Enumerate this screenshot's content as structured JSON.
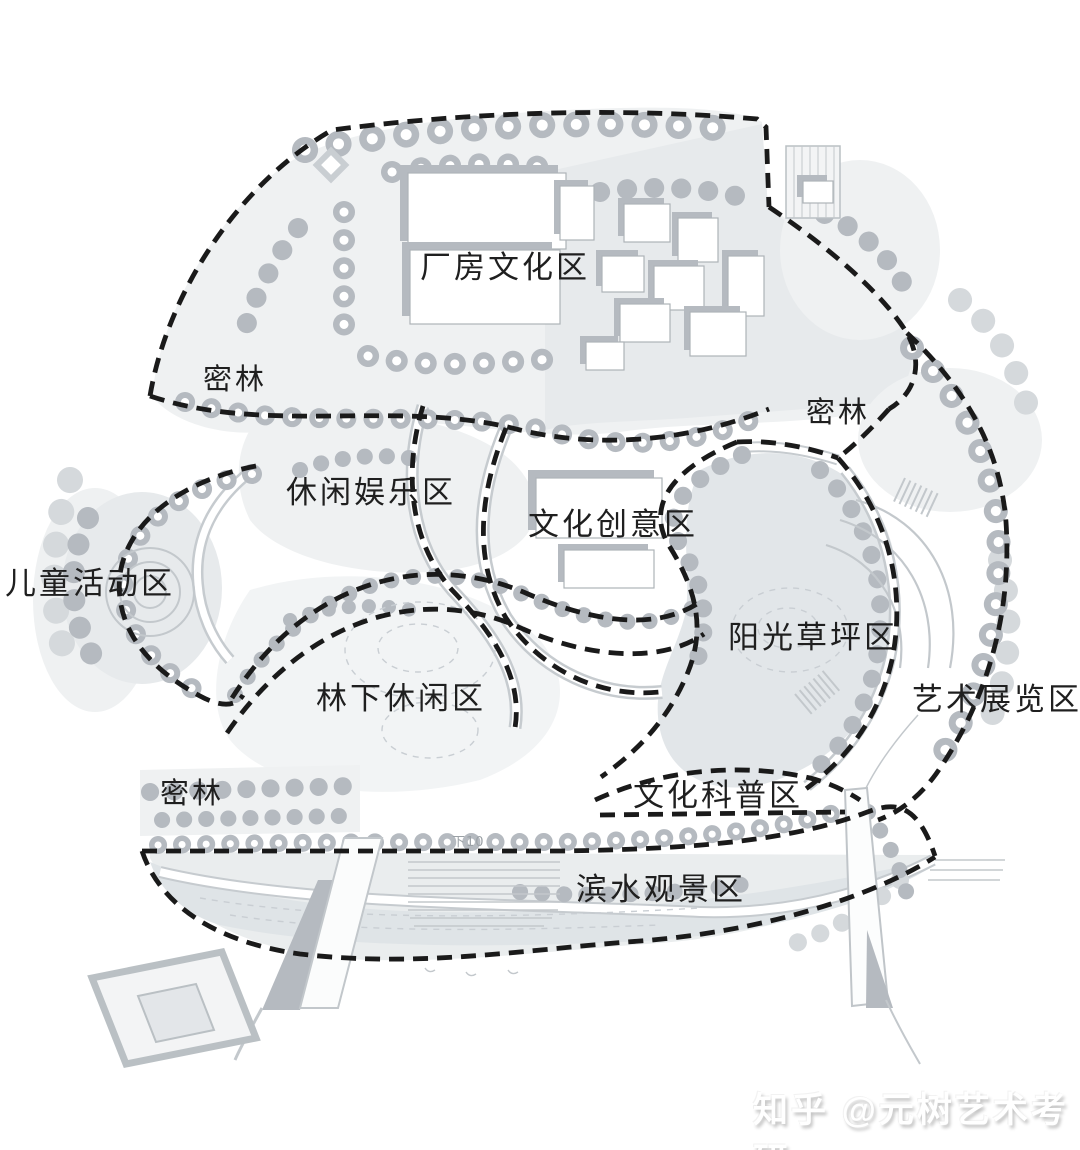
{
  "diagram": {
    "kind": "landscape functional zoning plan",
    "zones": [
      {
        "id": "factory-culture",
        "label": "厂房文化区"
      },
      {
        "id": "dense-forest-west",
        "label": "密林"
      },
      {
        "id": "dense-forest-east",
        "label": "密林"
      },
      {
        "id": "leisure-entertainment",
        "label": "休闲娱乐区"
      },
      {
        "id": "cultural-creative",
        "label": "文化创意区"
      },
      {
        "id": "children-activity",
        "label": "儿童活动区"
      },
      {
        "id": "sunny-lawn",
        "label": "阳光草坪区"
      },
      {
        "id": "forest-leisure",
        "label": "林下休闲区"
      },
      {
        "id": "art-exhibition",
        "label": "艺术展览区"
      },
      {
        "id": "culture-science",
        "label": "文化科普区"
      },
      {
        "id": "dense-forest-south",
        "label": "密林"
      },
      {
        "id": "waterfront-scenic",
        "label": "滨水观景区"
      }
    ],
    "annotations": {
      "slope_note": "下10"
    },
    "watermark": {
      "text": "知乎 @元树艺术考研"
    }
  },
  "colors": {
    "background": "#ffffff",
    "line_gray": "#b5bac0",
    "light_fill": "#e7eaec",
    "lighter_fill": "#eff1f2",
    "water_fill": "#dfe4e7",
    "boundary": "#1a1a1a",
    "label_color": "#1f1f1f",
    "detail_stroke": "#c6cbcf",
    "watermark_color": "#ffffff",
    "watermark_shadow": "#c4c4c4",
    "annotation_color": "#9ba1a6"
  }
}
